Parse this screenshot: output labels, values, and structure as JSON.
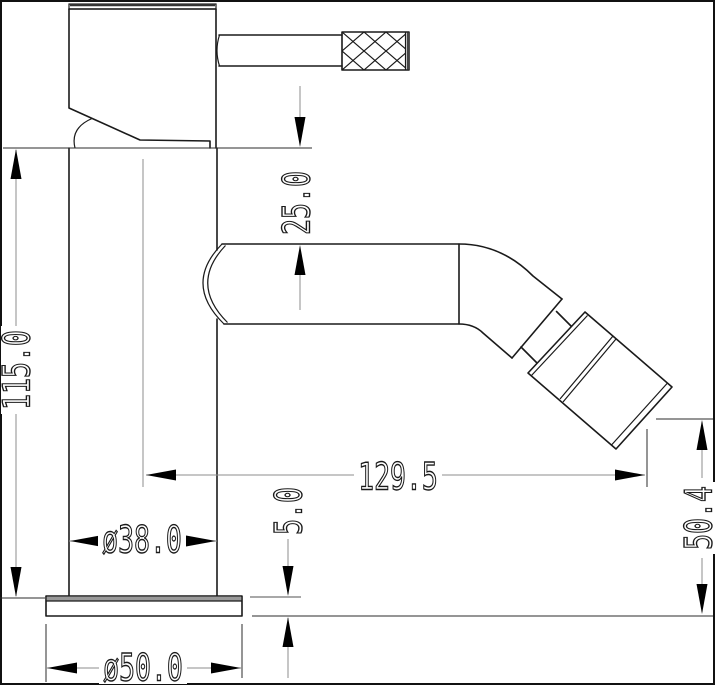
{
  "drawing": {
    "kind": "faucet-dimension-drawing",
    "colors": {
      "outline": "#1a1a1a",
      "dimension_line": "#8c8c8c",
      "extension_line": "#2b2b2b",
      "arrow": "#000000",
      "background": "#ffffff"
    },
    "dimensions": {
      "overall_height": "115.0",
      "spout_top_offset": "25.0",
      "spout_reach": "129.5",
      "outlet_height": "50.4",
      "base_plate_thickness": "5.0",
      "body_diameter": "ø38.0",
      "base_diameter": "ø50.0"
    }
  }
}
